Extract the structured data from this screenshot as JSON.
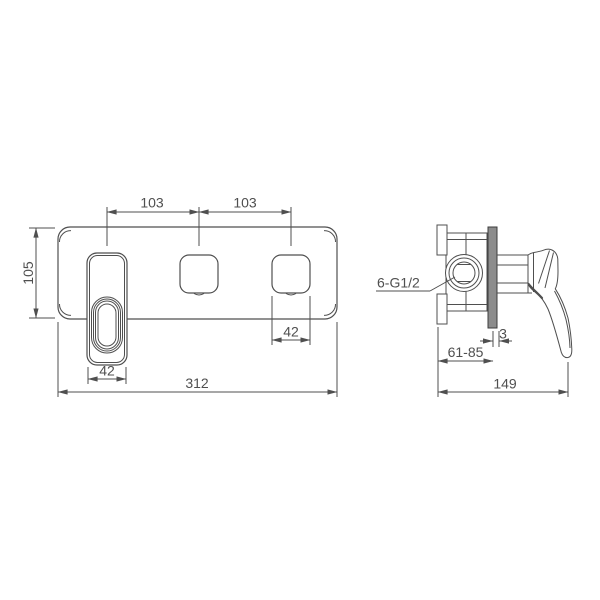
{
  "drawing": {
    "front_view": {
      "dim_spacing_left": "103",
      "dim_spacing_right": "103",
      "dim_plate_height": "105",
      "dim_handle_cutout_width": "42",
      "dim_outlet_cutout_width": "42",
      "dim_plate_width": "312"
    },
    "side_view": {
      "thread_label": "6-G1/2",
      "dim_plate_gap": "3",
      "dim_embed_depth_range": "61-85",
      "dim_total_depth": "149"
    },
    "colors": {
      "line": "#4f4f4f",
      "text": "#4f4f4f",
      "plate_side_fill": "#8c8c8c",
      "background": "#ffffff"
    }
  }
}
